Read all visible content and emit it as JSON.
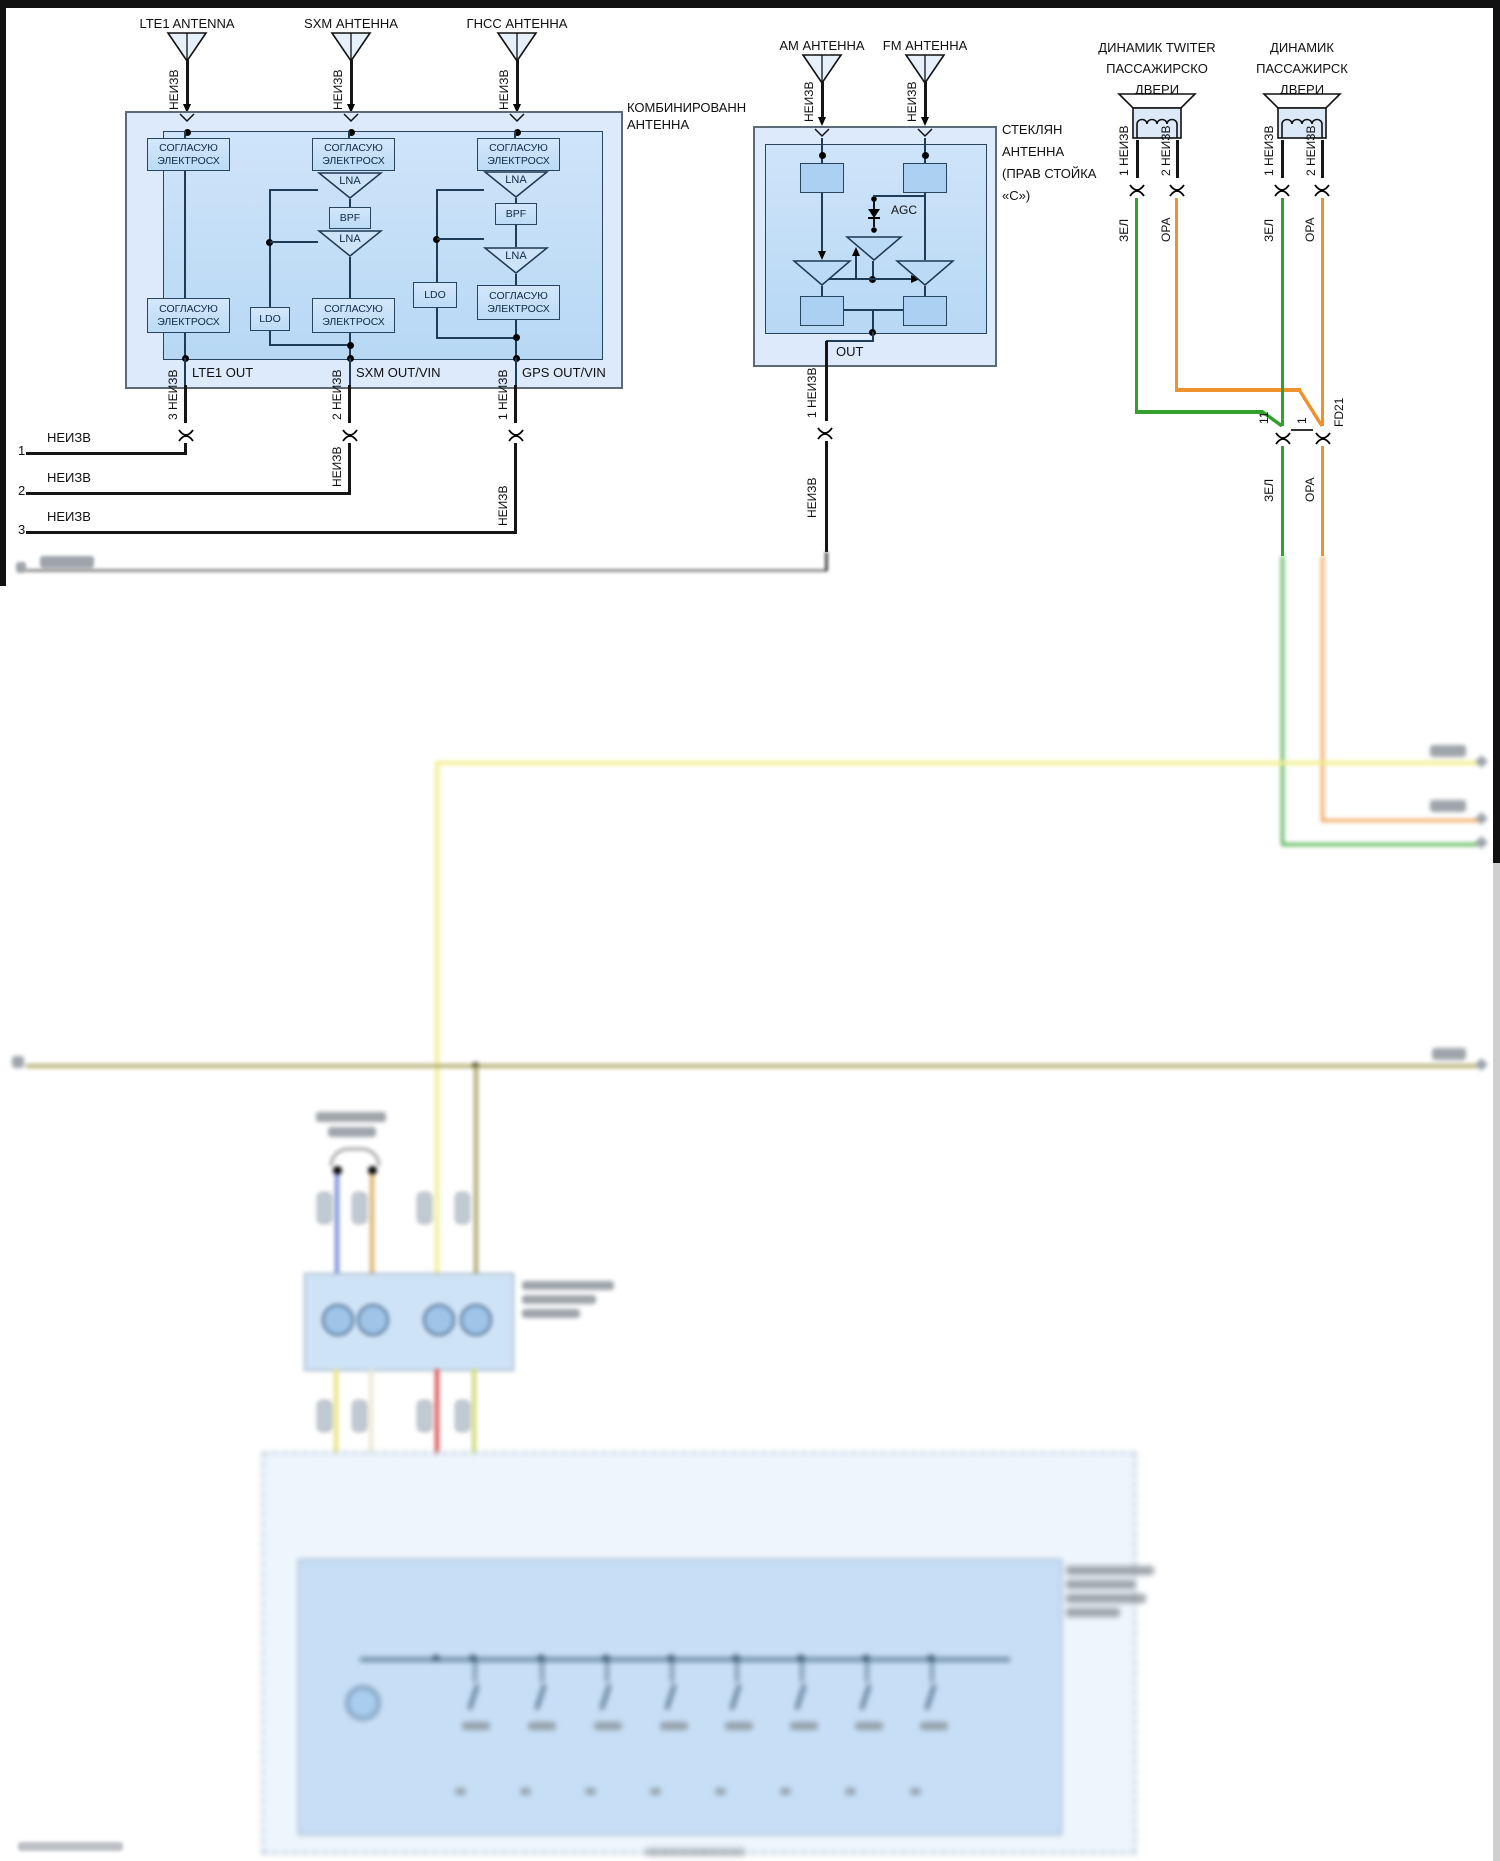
{
  "page": {
    "bg": "#ffffff",
    "frame_color": "#111111"
  },
  "labels": {
    "neizv": "НЕИЗВ",
    "zel": "ЗЕЛ",
    "ora": "ОРА",
    "lna": "LNA",
    "bpf": "BPF",
    "ldo": "LDO",
    "agc": "AGC",
    "out": "OUT",
    "match1": "СОГЛАСУЮ",
    "match2": "ЭЛЕКТРОСХ"
  },
  "combined_antenna": {
    "title": [
      "КОМБИНИРОВАНН",
      "АНТЕННА"
    ],
    "antennas": [
      {
        "label": "LTE1 ANTENNA",
        "wire": "НЕИЗВ"
      },
      {
        "label": "SXM АНТЕННА",
        "wire": "НЕИЗВ"
      },
      {
        "label": "ГНСС АНТЕННА",
        "wire": "НЕИЗВ"
      }
    ],
    "outputs": [
      "LTE1 OUT",
      "SXM OUT/VIN",
      "GPS OUT/VIN"
    ],
    "pins": [
      "3 НЕИЗВ",
      "2 НЕИЗВ",
      "1 НЕИЗВ"
    ]
  },
  "harness_rows": [
    {
      "num": "1",
      "label": "НЕИЗВ"
    },
    {
      "num": "2",
      "label": "НЕИЗВ"
    },
    {
      "num": "3",
      "label": "НЕИЗВ"
    }
  ],
  "glass_antenna": {
    "title": [
      "СТЕКЛЯН",
      "АНТЕННА",
      "(ПРАВ СТОЙКА",
      "«С»)"
    ],
    "antennas": [
      {
        "label": "AM АНТЕННА",
        "wire": "НЕИЗВ"
      },
      {
        "label": "FM АНТЕННА",
        "wire": "НЕИЗВ"
      }
    ],
    "out_pin": "1 НЕИЗВ",
    "below_wire": "НЕИЗВ"
  },
  "speakers": [
    {
      "title": [
        "ДИНАМИК TWITER",
        "ПАССАЖИРСКО",
        "ДВЕРИ"
      ],
      "pin1": "1 НЕИЗВ",
      "pin2": "2 НЕИЗВ",
      "wire1": "ЗЕЛ",
      "wire2": "ОРА"
    },
    {
      "title": [
        "ДИНАМИК",
        "ПАССАЖИРСК",
        "ДВЕРИ"
      ],
      "pin1": "1 НЕИЗВ",
      "pin2": "2 НЕИЗВ",
      "wire1": "ЗЕЛ",
      "wire2": "ОРА"
    }
  ],
  "inline_connectors": {
    "green_pin": "11",
    "orange_pin": "1",
    "orange_connector": "FD21",
    "below_green": "ЗЕЛ",
    "below_orange": "ОРА"
  },
  "colors": {
    "green": "#33a02c",
    "orange": "#f0922b",
    "yellow": "#f2ee8d",
    "olive": "#b5b172",
    "blue": "#6f86d8",
    "tan": "#d9ad62",
    "red": "#da4a4a",
    "yellow_green": "#ccd96a",
    "panel_fill": "#dceafb",
    "inner_fill": "#c6ddf6",
    "block_fill": "#abd0f2",
    "wire_black": "#151515"
  }
}
